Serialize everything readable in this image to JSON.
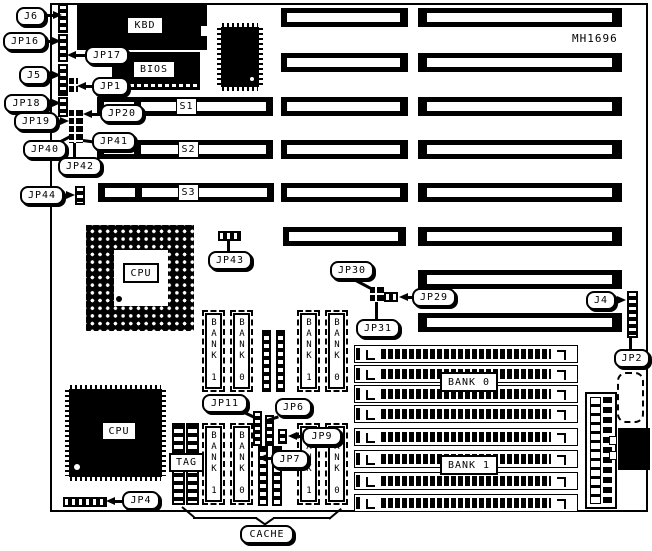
{
  "board": {
    "part_number": "MH1696"
  },
  "callouts": {
    "j6": "J6",
    "jp16": "JP16",
    "jp17": "JP17",
    "j5": "J5",
    "jp1": "JP1",
    "jp18": "JP18",
    "jp19": "JP19",
    "jp20": "JP20",
    "jp40": "JP40",
    "jp41": "JP41",
    "jp42": "JP42",
    "jp44": "JP44",
    "jp43": "JP43",
    "jp30": "JP30",
    "jp29": "JP29",
    "jp31": "JP31",
    "j4": "J4",
    "jp2": "JP2",
    "jp11": "JP11",
    "jp6": "JP6",
    "jp9": "JP9",
    "jp7": "JP7",
    "jp4": "JP4",
    "cache": "CACHE"
  },
  "chips": {
    "kbd": "KBD",
    "bios": "BIOS",
    "cpu_socket": "CPU",
    "cpu_qfp": "CPU",
    "tag": "TAG"
  },
  "slots": {
    "s1": "S1",
    "s2": "S2",
    "s3": "S3"
  },
  "memory": {
    "bank0_label": "BANK 0",
    "bank1_label": "BANK 1",
    "vertical_top": [
      "BANK 1",
      "BANK 0",
      "BANK 1",
      "BANK 0"
    ],
    "vertical_bottom": [
      "BANK 1",
      "BANK 0",
      "BANK 1",
      "BANK 0"
    ]
  },
  "colors": {
    "ink": "#000000",
    "paper": "#ffffff"
  }
}
